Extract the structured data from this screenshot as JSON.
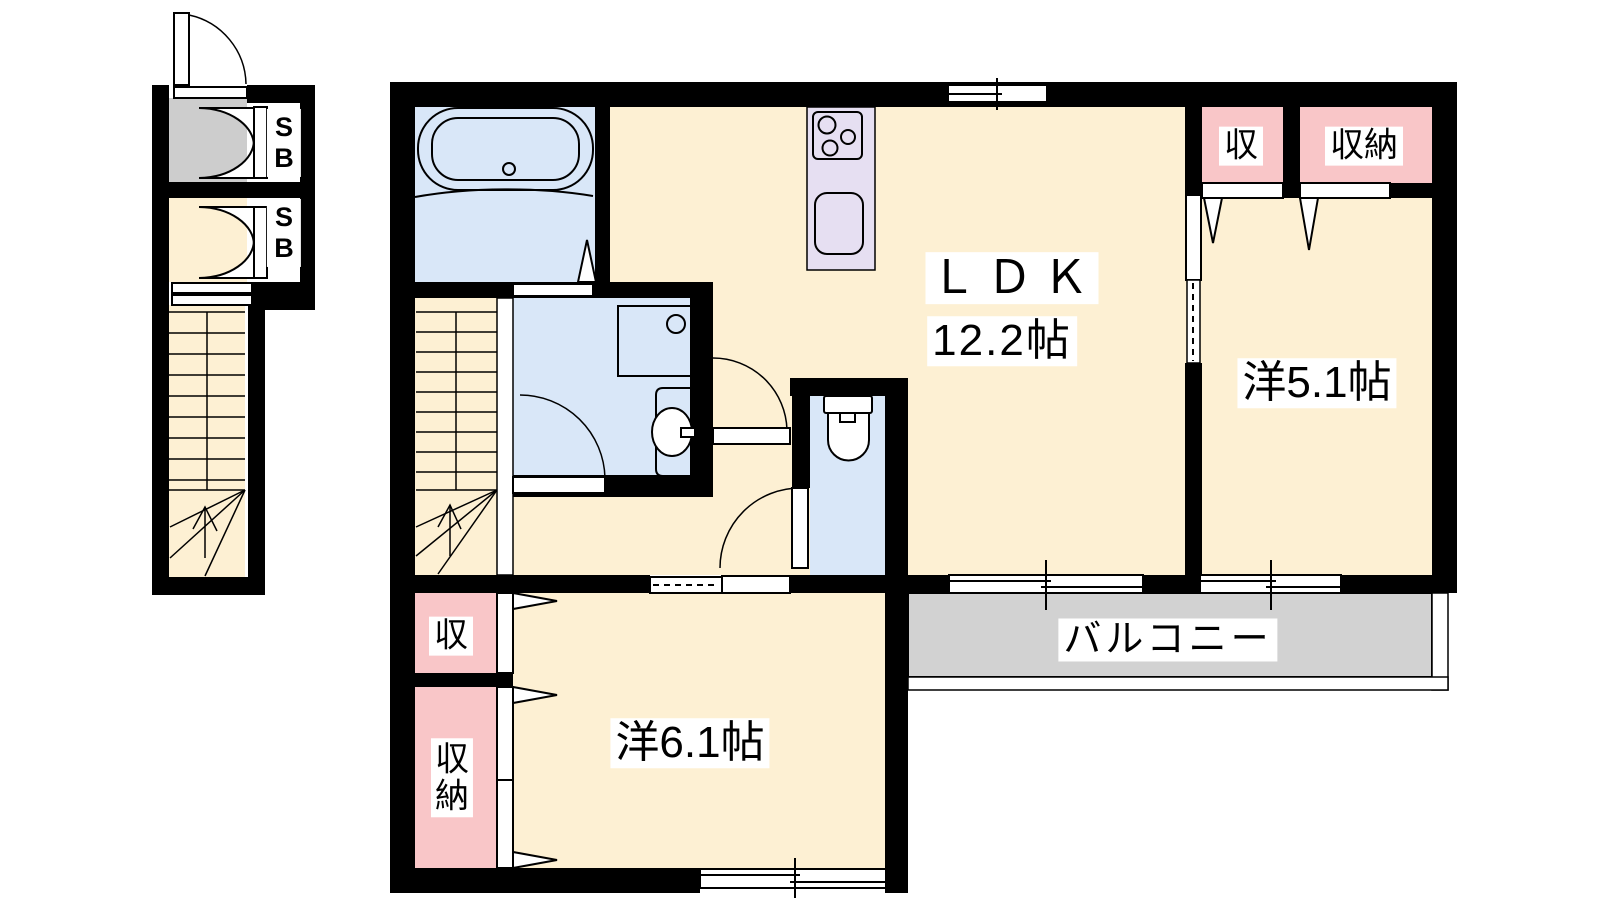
{
  "colors": {
    "wall": "#000000",
    "floor": "#fdf0d3",
    "wet_area": "#d9e7f8",
    "closet": "#f9c6c8",
    "kitchen_counter": "#e6dff2",
    "balcony": "#d2d2d2",
    "porch": "#cdcdcd",
    "label_bg": "#ffffff",
    "label_text": "#000000"
  },
  "rooms": {
    "ldk": {
      "name": "ＬＤＫ",
      "size": "12.2帖"
    },
    "bedroom_east": {
      "name": "洋5.1帖"
    },
    "bedroom_south": {
      "name": "洋6.1帖"
    },
    "balcony": {
      "name": "バルコニー"
    }
  },
  "storage": {
    "shoe_box": "SB",
    "closet_short": "収",
    "closet_full": "収納"
  }
}
